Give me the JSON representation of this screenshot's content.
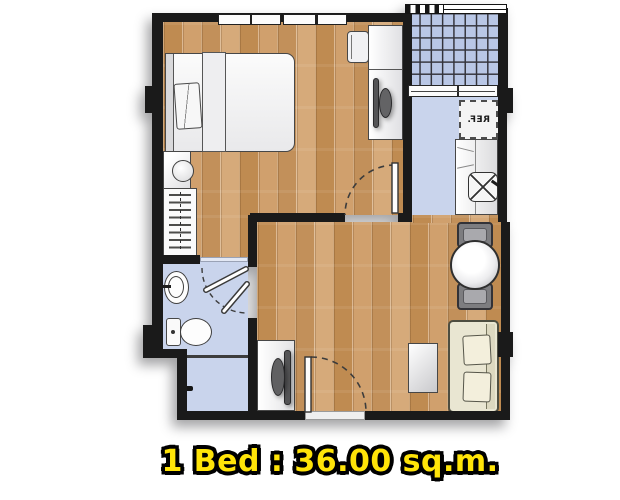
{
  "caption": {
    "text": "1 Bed : 36.00 sq.m.",
    "text_color": "#ffe408",
    "outline_color": "#000000"
  },
  "labels": {
    "refrigerator": "REF."
  },
  "palette": {
    "wall": "#1a1a1a",
    "wood_floor": "#c99a64",
    "tile_floor": "#c9d4ec",
    "balcony_tile": "#b9c7e6",
    "sofa_cream": "#e9e6d2",
    "furniture_white": "#f7f7f7",
    "chair_gray": "#7d7d80",
    "caption_yellow": "#ffe408"
  },
  "plan": {
    "rooms": [
      "bedroom",
      "wardrobe-corridor",
      "bathroom",
      "shower",
      "kitchen",
      "living-dining",
      "balcony"
    ],
    "furniture": [
      "double-bed",
      "pillow",
      "nightstand",
      "table-lamp",
      "wardrobe-hanger-rail",
      "desk",
      "desk-chair",
      "monitor",
      "refrigerator",
      "kitchen-counter",
      "kitchen-sink",
      "dining-table",
      "dining-chair",
      "sofa",
      "sofa-pillows",
      "coffee-table",
      "tv-stand",
      "tv",
      "washbasin",
      "toilet",
      "shower-head"
    ],
    "openings": [
      "entrance-door",
      "bedroom-door",
      "bathroom-folding-door",
      "balcony-sliding-door",
      "bedroom-windows",
      "balcony-railing"
    ]
  }
}
